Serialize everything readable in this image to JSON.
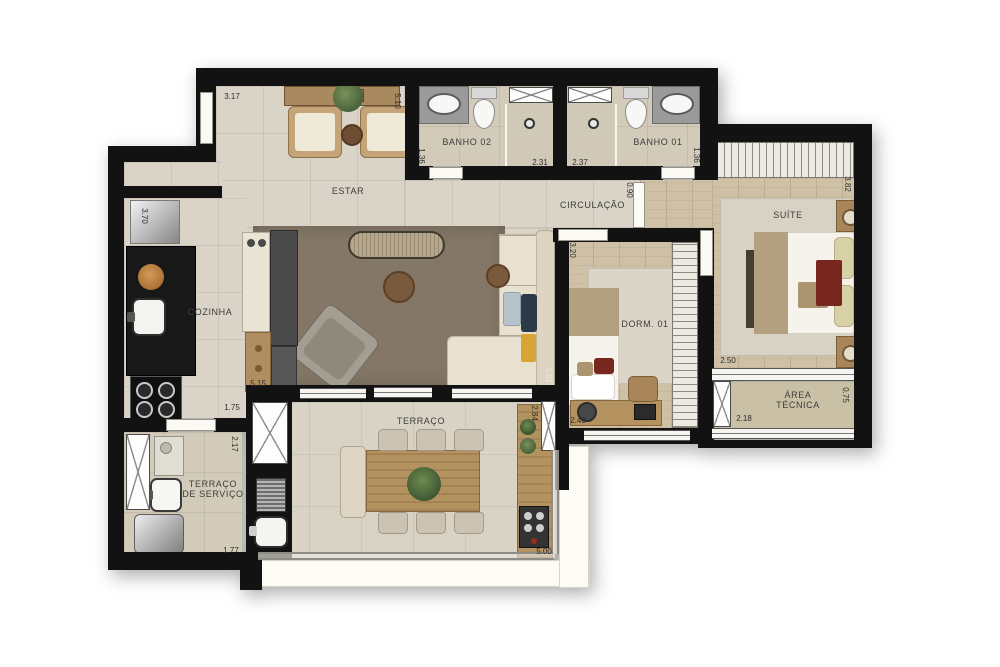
{
  "plan": {
    "rooms": {
      "estar": "ESTAR",
      "cozinha": "COZINHA",
      "banho02": "BANHO 02",
      "banho01": "BANHO 01",
      "circulacao": "CIRCULAÇÃO",
      "suite": "SUÍTE",
      "dorm01": "DORM. 01",
      "terraco": "TERRAÇO",
      "terraco_servico_l1": "TERRAÇO",
      "terraco_servico_l2": "DE SERVIÇO",
      "area_tecnica_l1": "ÁREA",
      "area_tecnica_l2": "TÉCNICA"
    },
    "dims": {
      "estar_top": "3.17",
      "estar_side": "5.10",
      "banho02_side": "1.36",
      "banho02_width": "2.31",
      "banho01_width": "2.37",
      "banho01_side": "1.36",
      "circ_door": "0.90",
      "suite_side": "3.82",
      "suite_width": "2.50",
      "areatec_side": "0.75",
      "areatec_width": "2.18",
      "dorm_side": "3.20",
      "dorm_width": "2.40",
      "estar_terr_side": "3.61",
      "terraco_side": "2.84",
      "terraco_width": "5.00",
      "cozinha_side": "3.70",
      "island_len": "5.15",
      "cozinha_width": "1.75",
      "servico_side": "2.17",
      "servico_width": "1.77"
    },
    "colors": {
      "wall": "#121212",
      "tile_floor": "#d9d4c7",
      "wood_floor": "#cfc1a6",
      "living_rug": "#847767",
      "counter_black": "#181818",
      "wood_furniture": "#b3925f"
    }
  }
}
